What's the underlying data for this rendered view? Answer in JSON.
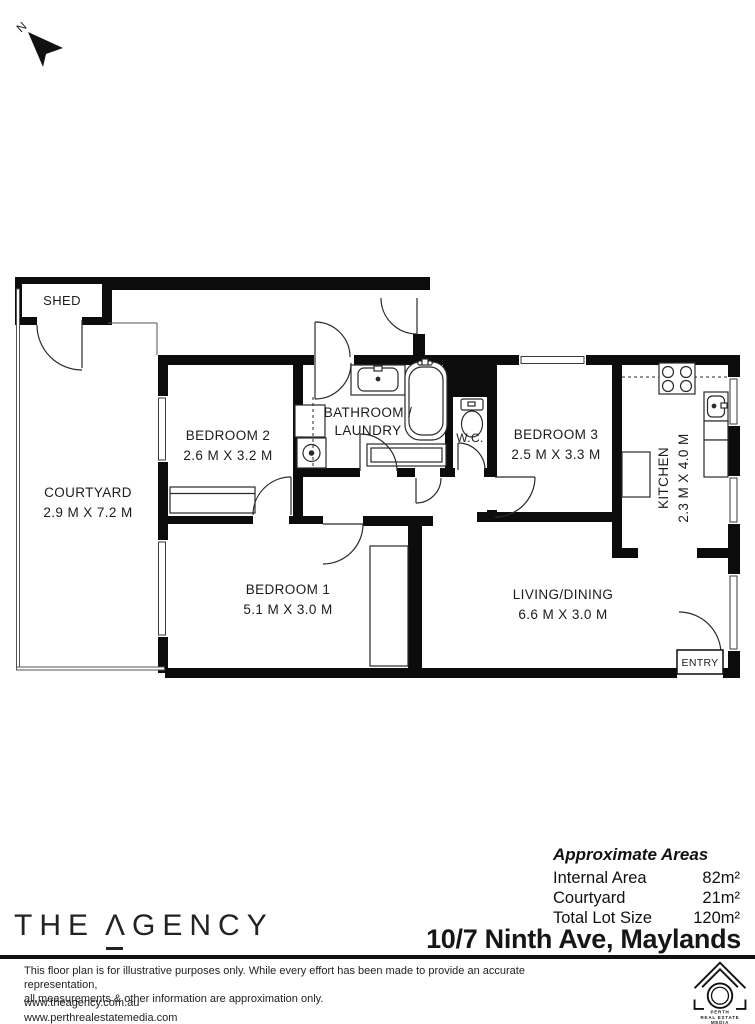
{
  "north_label": "N",
  "plan": {
    "shed": "SHED",
    "courtyard": {
      "name": "COURTYARD",
      "dims": "2.9 M X 7.2 M"
    },
    "bedroom2": {
      "name": "BEDROOM 2",
      "dims": "2.6 M X 3.2 M"
    },
    "bathroom": {
      "line1": "BATHROOM /",
      "line2": "LAUNDRY"
    },
    "wc": "W.C.",
    "bedroom3": {
      "name": "BEDROOM 3",
      "dims": "2.5 M X 3.3 M"
    },
    "kitchen": {
      "name": "KITCHEN",
      "dims": "2.3 M X 4.0 M"
    },
    "bedroom1": {
      "name": "BEDROOM 1",
      "dims": "5.1 M X 3.0 M"
    },
    "living": {
      "name": "LIVING/DINING",
      "dims": "6.6 M X 3.0 M"
    },
    "entry": "ENTRY"
  },
  "areas": {
    "heading": "Approximate Areas",
    "rows": [
      {
        "label": "Internal Area",
        "value": "82m²"
      },
      {
        "label": "Courtyard",
        "value": "21m²"
      },
      {
        "label": "Total Lot Size",
        "value": "120m²"
      }
    ]
  },
  "address": "10/7 Ninth Ave, Maylands",
  "brand": {
    "the": "THE",
    "a": "Λ",
    "rest": "GENCY"
  },
  "footer": {
    "disclaimer1": "This floor plan is for illustrative purposes only. While every effort has been made to provide an accurate representation,",
    "disclaimer2": "all measurements & other information are approximation only.",
    "url1": "www.theagency.com.au",
    "url2": "www.perthrealestatemedia.com",
    "prem": {
      "line1": "PERTH",
      "line2": "REAL ESTATE",
      "line3": "MEDIA"
    }
  },
  "colors": {
    "wall": "#0c0c0c",
    "line": "#2a2a2a",
    "text": "#1c1c1c"
  }
}
